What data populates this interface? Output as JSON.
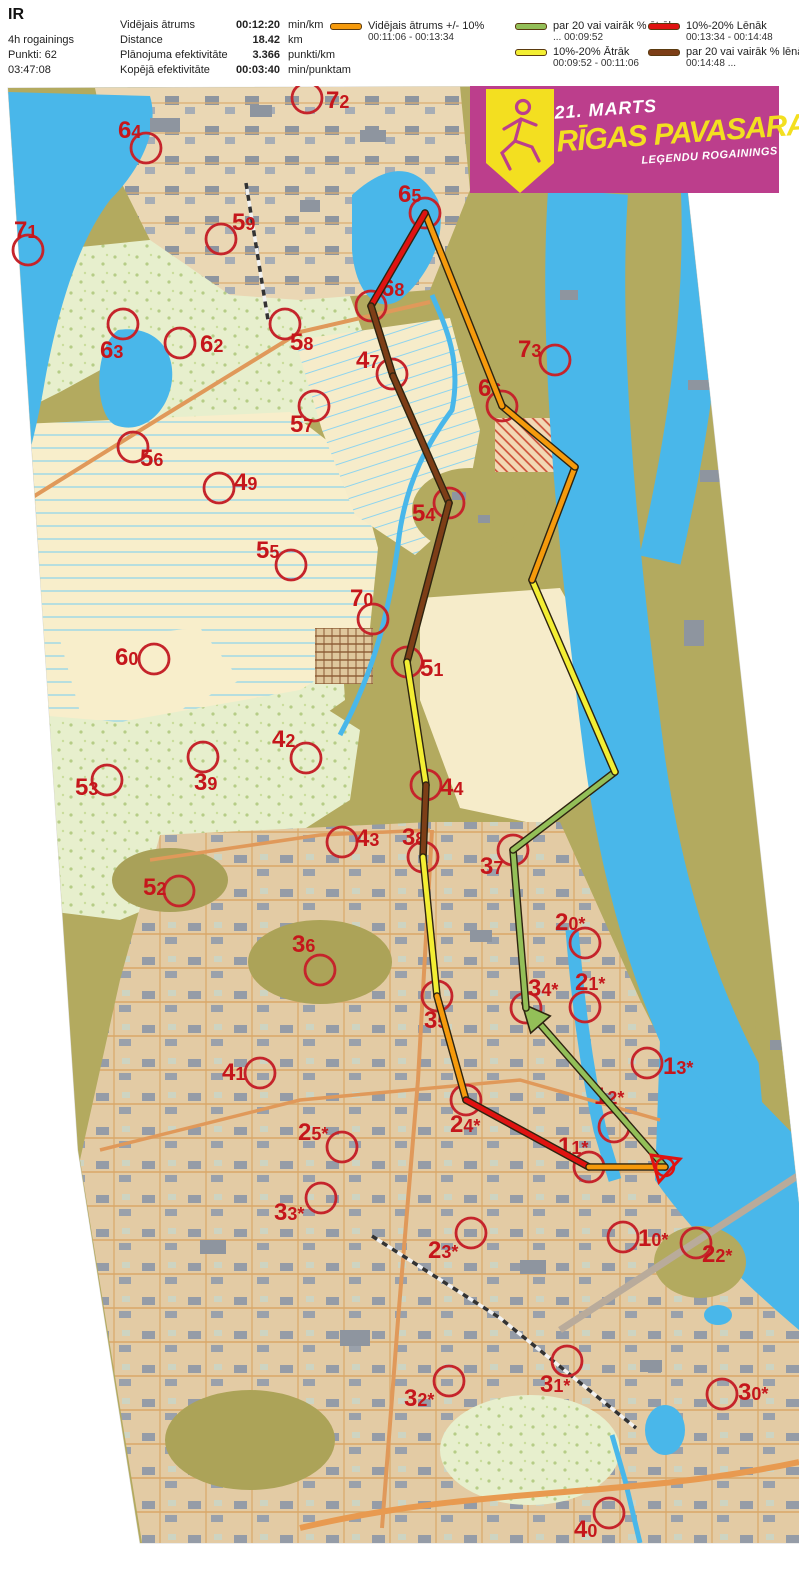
{
  "page": {
    "title": "IR"
  },
  "header": {
    "left_lines": [
      "4h rogainings",
      "Punkti: 62",
      "03:47:08"
    ],
    "stats": [
      {
        "label": "Vidējais ātrums",
        "value": "00:12:20",
        "unit": "min/km"
      },
      {
        "label": "Distance",
        "value": "18.42",
        "unit": "km"
      },
      {
        "label": "Plānojuma efektivitāte",
        "value": "3.366",
        "unit": "punkti/km"
      },
      {
        "label": "Kopējā efektivitāte",
        "value": "00:03:40",
        "unit": "min/punktam"
      }
    ]
  },
  "legend": {
    "items": [
      {
        "col": 0,
        "label": "Vidējais ātrums +/- 10%",
        "range": "00:11:06  -  00:13:34",
        "cat": "avg"
      },
      {
        "col": 1,
        "label": "par 20 vai vairāk % ātrāk",
        "range": "...   00:09:52",
        "cat": "faster"
      },
      {
        "col": 1,
        "label": "10%-20% Ātrāk",
        "range": "00:09:52  -  00:11:06",
        "cat": "fast"
      },
      {
        "col": 2,
        "label": "10%-20% Lēnāk",
        "range": "00:13:34  -  00:14:48",
        "cat": "slow"
      },
      {
        "col": 2,
        "label": "par 20 vai vairāk % lēnāk",
        "range": "00:14:48   ...",
        "cat": "slower"
      }
    ]
  },
  "banner": {
    "date": "21. MARTS",
    "title": "RĪGAS PAVASARA",
    "subtitle": "LEĢENDU ROGAININGS"
  },
  "colors": {
    "banner_bg": "#bc3e8c",
    "shield_yellow": "#f3df20",
    "control_red": "#c5242b",
    "route_outline": "#2e2410",
    "route": {
      "avg": "#f59a0c",
      "fast": "#f3ee33",
      "faster": "#93bf58",
      "slow": "#e01311",
      "slower": "#7d3e17"
    }
  },
  "map": {
    "start": {
      "x": 665,
      "y": 1167
    },
    "controls": [
      {
        "id": "72",
        "cx": 307,
        "cy": 98,
        "lx": 326,
        "ly": 108
      },
      {
        "id": "64",
        "cx": 146,
        "cy": 148,
        "lx": 118,
        "ly": 138
      },
      {
        "id": "71",
        "cx": 28,
        "cy": 250,
        "lx": 14,
        "ly": 238
      },
      {
        "id": "59",
        "cx": 221,
        "cy": 239,
        "lx": 232,
        "ly": 230
      },
      {
        "id": "63",
        "cx": 123,
        "cy": 324,
        "lx": 100,
        "ly": 358
      },
      {
        "id": "62",
        "cx": 180,
        "cy": 343,
        "lx": 200,
        "ly": 352
      },
      {
        "id": "58",
        "cx": 285,
        "cy": 324,
        "lx": 290,
        "ly": 350
      },
      {
        "id": "65",
        "cx": 425,
        "cy": 213,
        "lx": 398,
        "ly": 202
      },
      {
        "id": "68",
        "cx": 371,
        "cy": 306,
        "lx": 381,
        "ly": 296
      },
      {
        "id": "47",
        "cx": 392,
        "cy": 374,
        "lx": 356,
        "ly": 368
      },
      {
        "id": "73",
        "cx": 555,
        "cy": 360,
        "lx": 518,
        "ly": 357
      },
      {
        "id": "66",
        "cx": 502,
        "cy": 406,
        "lx": 478,
        "ly": 396
      },
      {
        "id": "57",
        "cx": 314,
        "cy": 406,
        "lx": 290,
        "ly": 432
      },
      {
        "id": "56",
        "cx": 133,
        "cy": 447,
        "lx": 140,
        "ly": 466
      },
      {
        "id": "49",
        "cx": 219,
        "cy": 488,
        "lx": 234,
        "ly": 490
      },
      {
        "id": "54",
        "cx": 449,
        "cy": 503,
        "lx": 412,
        "ly": 521
      },
      {
        "id": "55",
        "cx": 291,
        "cy": 565,
        "lx": 256,
        "ly": 558
      },
      {
        "id": "70",
        "cx": 373,
        "cy": 619,
        "lx": 350,
        "ly": 606
      },
      {
        "id": "51",
        "cx": 407,
        "cy": 662,
        "lx": 420,
        "ly": 676
      },
      {
        "id": "60",
        "cx": 154,
        "cy": 659,
        "lx": 115,
        "ly": 665
      },
      {
        "id": "42",
        "cx": 306,
        "cy": 758,
        "lx": 272,
        "ly": 747
      },
      {
        "id": "39",
        "cx": 203,
        "cy": 757,
        "lx": 194,
        "ly": 790
      },
      {
        "id": "53",
        "cx": 107,
        "cy": 780,
        "lx": 75,
        "ly": 795
      },
      {
        "id": "44",
        "cx": 426,
        "cy": 785,
        "lx": 440,
        "ly": 795
      },
      {
        "id": "43",
        "cx": 342,
        "cy": 842,
        "lx": 356,
        "ly": 846
      },
      {
        "id": "38",
        "cx": 423,
        "cy": 857,
        "lx": 402,
        "ly": 845
      },
      {
        "id": "37",
        "cx": 513,
        "cy": 850,
        "lx": 480,
        "ly": 874
      },
      {
        "id": "52",
        "cx": 179,
        "cy": 891,
        "lx": 143,
        "ly": 895
      },
      {
        "id": "20*",
        "cx": 585,
        "cy": 943,
        "lx": 555,
        "ly": 930
      },
      {
        "id": "36",
        "cx": 320,
        "cy": 970,
        "lx": 292,
        "ly": 952
      },
      {
        "id": "34*",
        "cx": 526,
        "cy": 1008,
        "lx": 528,
        "ly": 996
      },
      {
        "id": "21*",
        "cx": 585,
        "cy": 1007,
        "lx": 575,
        "ly": 990
      },
      {
        "id": "35",
        "cx": 437,
        "cy": 996,
        "lx": 424,
        "ly": 1028
      },
      {
        "id": "41",
        "cx": 260,
        "cy": 1073,
        "lx": 222,
        "ly": 1080
      },
      {
        "id": "13*",
        "cx": 647,
        "cy": 1063,
        "lx": 663,
        "ly": 1074
      },
      {
        "id": "24*",
        "cx": 466,
        "cy": 1100,
        "lx": 450,
        "ly": 1132
      },
      {
        "id": "12*",
        "cx": 614,
        "cy": 1127,
        "lx": 594,
        "ly": 1104
      },
      {
        "id": "25*",
        "cx": 342,
        "cy": 1147,
        "lx": 298,
        "ly": 1140
      },
      {
        "id": "11*",
        "cx": 589,
        "cy": 1167,
        "lx": 558,
        "ly": 1154
      },
      {
        "id": "33*",
        "cx": 321,
        "cy": 1198,
        "lx": 274,
        "ly": 1220
      },
      {
        "id": "23*",
        "cx": 471,
        "cy": 1233,
        "lx": 428,
        "ly": 1258
      },
      {
        "id": "10*",
        "cx": 623,
        "cy": 1237,
        "lx": 638,
        "ly": 1246
      },
      {
        "id": "22*",
        "cx": 696,
        "cy": 1243,
        "lx": 702,
        "ly": 1262
      },
      {
        "id": "32*",
        "cx": 449,
        "cy": 1381,
        "lx": 404,
        "ly": 1406
      },
      {
        "id": "31*",
        "cx": 567,
        "cy": 1361,
        "lx": 540,
        "ly": 1392
      },
      {
        "id": "30*",
        "cx": 722,
        "cy": 1394,
        "lx": 738,
        "ly": 1400
      },
      {
        "id": "40",
        "cx": 609,
        "cy": 1513,
        "lx": 574,
        "ly": 1537
      }
    ],
    "route": [
      {
        "x1": 665,
        "y1": 1167,
        "x2": 526,
        "y2": 1008,
        "cat": "faster",
        "arrow": true
      },
      {
        "x1": 526,
        "y1": 1008,
        "x2": 513,
        "y2": 850,
        "cat": "faster"
      },
      {
        "x1": 513,
        "y1": 850,
        "x2": 615,
        "y2": 772,
        "cat": "faster"
      },
      {
        "x1": 615,
        "y1": 772,
        "x2": 532,
        "y2": 580,
        "cat": "fast"
      },
      {
        "x1": 532,
        "y1": 580,
        "x2": 575,
        "y2": 467,
        "cat": "avg"
      },
      {
        "x1": 575,
        "y1": 467,
        "x2": 502,
        "y2": 406,
        "cat": "avg"
      },
      {
        "x1": 502,
        "y1": 406,
        "x2": 425,
        "y2": 213,
        "cat": "avg"
      },
      {
        "x1": 425,
        "y1": 213,
        "x2": 371,
        "y2": 306,
        "cat": "slow"
      },
      {
        "x1": 371,
        "y1": 306,
        "x2": 393,
        "y2": 376,
        "cat": "slower"
      },
      {
        "x1": 393,
        "y1": 376,
        "x2": 449,
        "y2": 503,
        "cat": "slower"
      },
      {
        "x1": 449,
        "y1": 503,
        "x2": 407,
        "y2": 662,
        "cat": "slower"
      },
      {
        "x1": 407,
        "y1": 662,
        "x2": 426,
        "y2": 785,
        "cat": "fast"
      },
      {
        "x1": 426,
        "y1": 785,
        "x2": 423,
        "y2": 857,
        "cat": "slower"
      },
      {
        "x1": 423,
        "y1": 857,
        "x2": 437,
        "y2": 996,
        "cat": "fast"
      },
      {
        "x1": 437,
        "y1": 996,
        "x2": 466,
        "y2": 1100,
        "cat": "avg"
      },
      {
        "x1": 466,
        "y1": 1100,
        "x2": 589,
        "y2": 1167,
        "cat": "slow"
      },
      {
        "x1": 589,
        "y1": 1167,
        "x2": 665,
        "y2": 1167,
        "cat": "avg"
      }
    ]
  }
}
